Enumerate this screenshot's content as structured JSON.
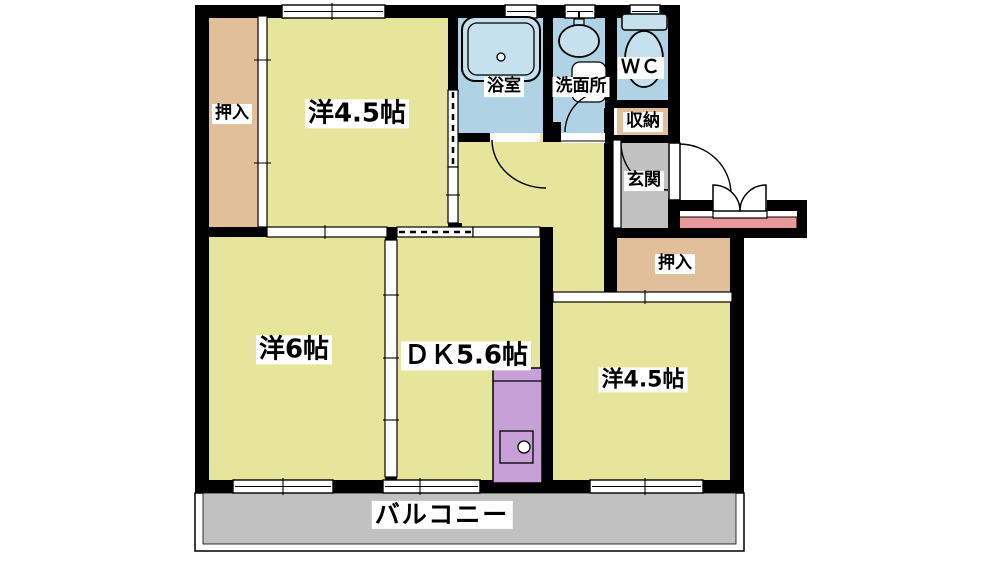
{
  "labels": {
    "room_top": "洋4.5帖",
    "closet_top_left": "押入",
    "bath": "浴室",
    "washroom": "洗面所",
    "wc": "ＷＣ",
    "storage": "収納",
    "entrance": "玄関",
    "closet_right": "押入",
    "room_left": "洋6帖",
    "dining_kitchen": "ＤＫ5.6帖",
    "room_right": "洋4.5帖",
    "balcony": "バルコニー"
  },
  "colors": {
    "room_floor": "#E5E59B",
    "closet": "#E0BF9A",
    "wet_area": "#AFD3E4",
    "fixture": "#C6E0ED",
    "entrance_floor": "#C1C1C1",
    "balcony_floor": "#C1C1C1",
    "entrance_step": "#E9999C",
    "kitchen_counter": "#C7A0D8",
    "wall": "#000000",
    "background": "#FFFFFF"
  }
}
